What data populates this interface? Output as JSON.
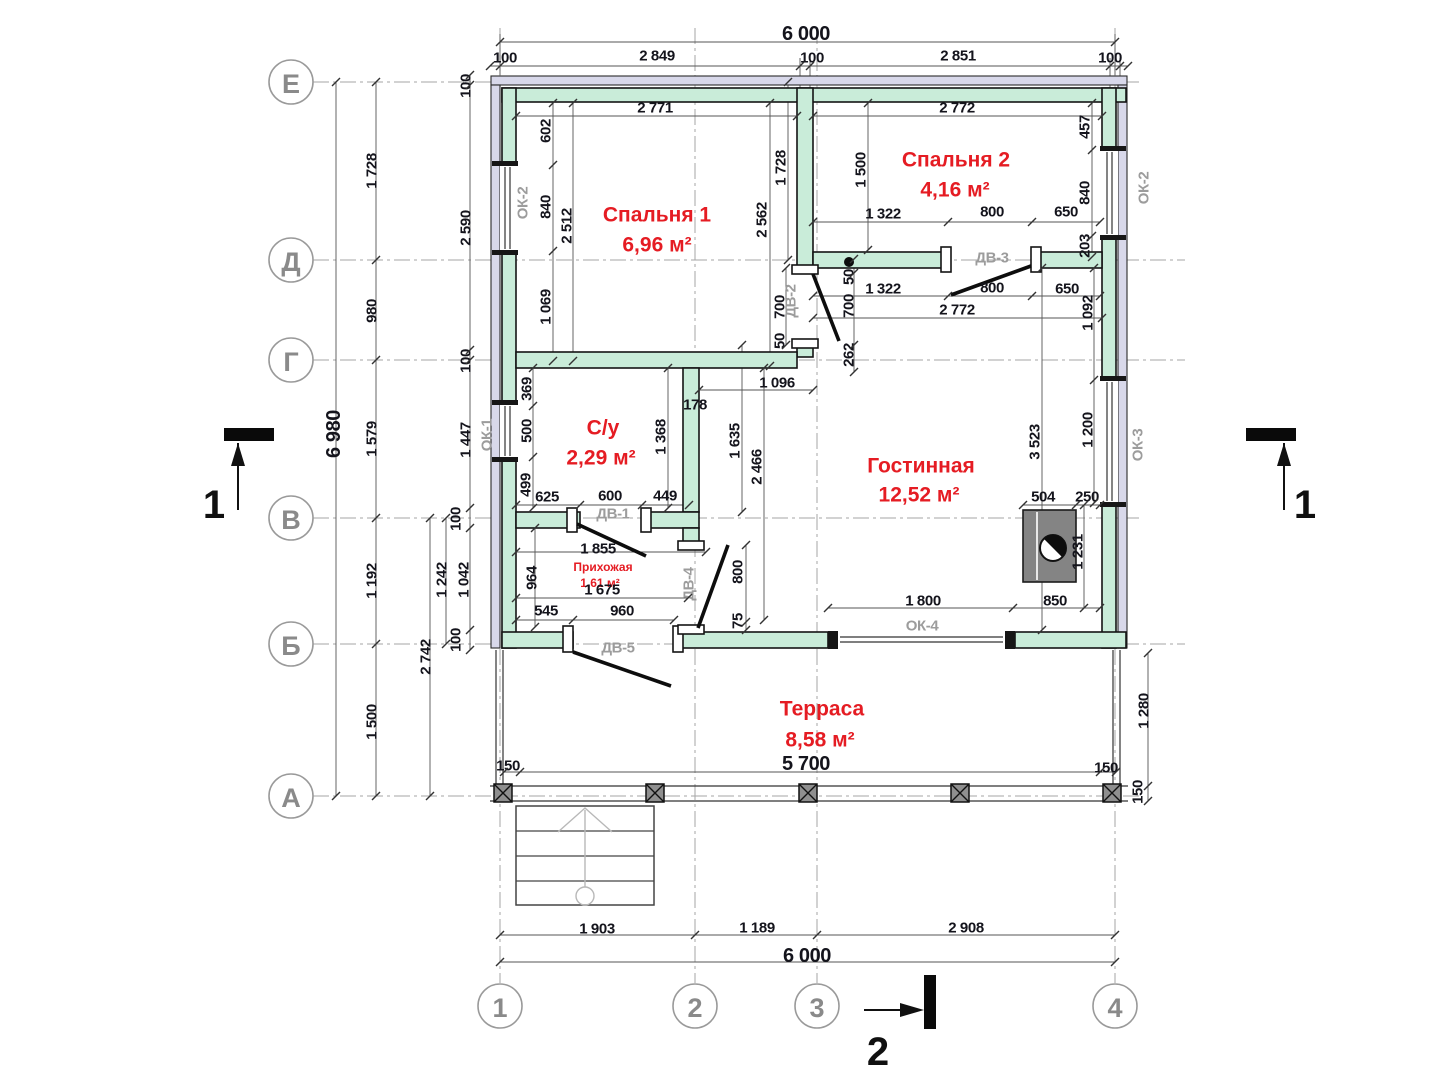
{
  "drawing": {
    "kind": "house floor plan",
    "overall_width": "6 000",
    "overall_height": "6 980"
  },
  "rooms": [
    {
      "name": "Спальня 1",
      "area": "6,96 м²"
    },
    {
      "name": "Спальня 2",
      "area": "4,16 м²"
    },
    {
      "name": "С/у",
      "area": "2,29 м²"
    },
    {
      "name": "Гостинная",
      "area": "12,52 м²"
    },
    {
      "name": "Прихожая",
      "area": "1,61 м²"
    },
    {
      "name": "Терраса",
      "area": "8,58 м²"
    }
  ],
  "axes": {
    "rows": [
      {
        "label": "Е"
      },
      {
        "label": "Д"
      },
      {
        "label": "Г"
      },
      {
        "label": "В"
      },
      {
        "label": "Б"
      },
      {
        "label": "А"
      }
    ],
    "cols": [
      {
        "label": "1"
      },
      {
        "label": "2"
      },
      {
        "label": "3"
      },
      {
        "label": "4"
      }
    ]
  },
  "section_labels": [
    {
      "label": "1"
    },
    {
      "label": "1"
    },
    {
      "label": "2"
    }
  ],
  "opening_labels": [
    {
      "t": "ОК-2",
      "x": 523,
      "y": 203,
      "r": 1
    },
    {
      "t": "ОК-1",
      "x": 487,
      "y": 435,
      "r": 1
    },
    {
      "t": "ОК-2",
      "x": 1144,
      "y": 188,
      "r": 1
    },
    {
      "t": "ОК-3",
      "x": 1138,
      "y": 445,
      "r": 1
    },
    {
      "t": "ОК-4",
      "x": 922,
      "y": 626
    },
    {
      "t": "ДВ-1",
      "x": 613,
      "y": 514
    },
    {
      "t": "ДВ-2",
      "x": 791,
      "y": 301,
      "r": 1
    },
    {
      "t": "ДВ-3",
      "x": 992,
      "y": 258
    },
    {
      "t": "ДВ-4",
      "x": 689,
      "y": 584,
      "r": 1
    },
    {
      "t": "ДВ-5",
      "x": 618,
      "y": 648
    }
  ],
  "dimension_labels": [
    {
      "t": "6 000",
      "x": 806,
      "y": 34,
      "c": "L"
    },
    {
      "t": "100",
      "x": 505,
      "y": 58
    },
    {
      "t": "2 849",
      "x": 657,
      "y": 56
    },
    {
      "t": "100",
      "x": 812,
      "y": 58
    },
    {
      "t": "2 851",
      "x": 958,
      "y": 56
    },
    {
      "t": "100",
      "x": 1110,
      "y": 58
    },
    {
      "t": "2 771",
      "x": 655,
      "y": 108
    },
    {
      "t": "2 772",
      "x": 957,
      "y": 108
    },
    {
      "t": "602",
      "x": 546,
      "y": 131,
      "r": 1
    },
    {
      "t": "840",
      "x": 546,
      "y": 207,
      "r": 1
    },
    {
      "t": "1 069",
      "x": 546,
      "y": 307,
      "r": 1
    },
    {
      "t": "2 512",
      "x": 567,
      "y": 226,
      "r": 1
    },
    {
      "t": "2 562",
      "x": 762,
      "y": 220,
      "r": 1
    },
    {
      "t": "1 728",
      "x": 781,
      "y": 168,
      "r": 1
    },
    {
      "t": "1 500",
      "x": 861,
      "y": 170,
      "r": 1
    },
    {
      "t": "457",
      "x": 1085,
      "y": 127,
      "r": 1
    },
    {
      "t": "840",
      "x": 1085,
      "y": 193,
      "r": 1
    },
    {
      "t": "203",
      "x": 1085,
      "y": 246,
      "r": 1
    },
    {
      "t": "1 322",
      "x": 883,
      "y": 214
    },
    {
      "t": "800",
      "x": 992,
      "y": 212
    },
    {
      "t": "650",
      "x": 1066,
      "y": 212
    },
    {
      "t": "1 322",
      "x": 883,
      "y": 289
    },
    {
      "t": "800",
      "x": 992,
      "y": 288
    },
    {
      "t": "650",
      "x": 1067,
      "y": 289
    },
    {
      "t": "2 772",
      "x": 957,
      "y": 310
    },
    {
      "t": "50",
      "x": 849,
      "y": 277,
      "r": 1
    },
    {
      "t": "700",
      "x": 849,
      "y": 306,
      "r": 1
    },
    {
      "t": "262",
      "x": 849,
      "y": 355,
      "r": 1
    },
    {
      "t": "700",
      "x": 780,
      "y": 307,
      "r": 1
    },
    {
      "t": "50",
      "x": 780,
      "y": 341,
      "r": 1
    },
    {
      "t": "1 092",
      "x": 1088,
      "y": 313,
      "r": 1
    },
    {
      "t": "1 200",
      "x": 1088,
      "y": 430,
      "r": 1
    },
    {
      "t": "3 523",
      "x": 1035,
      "y": 442,
      "r": 1
    },
    {
      "t": "504",
      "x": 1043,
      "y": 497
    },
    {
      "t": "250",
      "x": 1087,
      "y": 497
    },
    {
      "t": "1 231",
      "x": 1078,
      "y": 552,
      "r": 1
    },
    {
      "t": "850",
      "x": 1055,
      "y": 601
    },
    {
      "t": "1 800",
      "x": 923,
      "y": 601
    },
    {
      "t": "369",
      "x": 527,
      "y": 389,
      "r": 1
    },
    {
      "t": "500",
      "x": 527,
      "y": 431,
      "r": 1
    },
    {
      "t": "499",
      "x": 526,
      "y": 485,
      "r": 1
    },
    {
      "t": "1 368",
      "x": 661,
      "y": 437,
      "r": 1
    },
    {
      "t": "178",
      "x": 695,
      "y": 405
    },
    {
      "t": "1 096",
      "x": 777,
      "y": 383
    },
    {
      "t": "1 635",
      "x": 735,
      "y": 441,
      "r": 1
    },
    {
      "t": "2 466",
      "x": 757,
      "y": 467,
      "r": 1
    },
    {
      "t": "625",
      "x": 547,
      "y": 497
    },
    {
      "t": "600",
      "x": 610,
      "y": 496
    },
    {
      "t": "449",
      "x": 665,
      "y": 496
    },
    {
      "t": "1 855",
      "x": 598,
      "y": 549
    },
    {
      "t": "1 675",
      "x": 602,
      "y": 590
    },
    {
      "t": "964",
      "x": 532,
      "y": 578,
      "r": 1
    },
    {
      "t": "545",
      "x": 546,
      "y": 611
    },
    {
      "t": "960",
      "x": 622,
      "y": 611
    },
    {
      "t": "800",
      "x": 738,
      "y": 572,
      "r": 1
    },
    {
      "t": "75",
      "x": 738,
      "y": 621,
      "r": 1
    },
    {
      "t": "6 980",
      "x": 334,
      "y": 434,
      "c": "L",
      "r": 1
    },
    {
      "t": "1 728",
      "x": 372,
      "y": 171,
      "r": 1
    },
    {
      "t": "980",
      "x": 372,
      "y": 311,
      "r": 1
    },
    {
      "t": "1 579",
      "x": 372,
      "y": 439,
      "r": 1
    },
    {
      "t": "1 192",
      "x": 372,
      "y": 581,
      "r": 1
    },
    {
      "t": "1 500",
      "x": 372,
      "y": 722,
      "r": 1
    },
    {
      "t": "2 742",
      "x": 426,
      "y": 657,
      "r": 1
    },
    {
      "t": "1 242",
      "x": 442,
      "y": 580,
      "r": 1
    },
    {
      "t": "1 042",
      "x": 464,
      "y": 580,
      "r": 1
    },
    {
      "t": "100",
      "x": 456,
      "y": 519,
      "r": 1
    },
    {
      "t": "100",
      "x": 456,
      "y": 640,
      "r": 1
    },
    {
      "t": "100",
      "x": 466,
      "y": 86,
      "r": 1
    },
    {
      "t": "2 590",
      "x": 466,
      "y": 228,
      "r": 1
    },
    {
      "t": "100",
      "x": 466,
      "y": 361,
      "r": 1
    },
    {
      "t": "1 447",
      "x": 466,
      "y": 440,
      "r": 1
    },
    {
      "t": "1 280",
      "x": 1144,
      "y": 711,
      "r": 1
    },
    {
      "t": "150",
      "x": 1106,
      "y": 768
    },
    {
      "t": "150",
      "x": 1138,
      "y": 792,
      "r": 1
    },
    {
      "t": "150",
      "x": 508,
      "y": 766
    },
    {
      "t": "5 700",
      "x": 806,
      "y": 764,
      "c": "L"
    },
    {
      "t": "1 903",
      "x": 597,
      "y": 929
    },
    {
      "t": "1 189",
      "x": 757,
      "y": 928
    },
    {
      "t": "2 908",
      "x": 966,
      "y": 928
    },
    {
      "t": "6 000",
      "x": 807,
      "y": 956,
      "c": "L"
    }
  ],
  "colors": {
    "wall_fill": "#c9ecd9",
    "wall_outer_band": "#d8d8ea",
    "room_text": "#e51c23",
    "dim_text": "#14141c",
    "tag_text": "#9c9c9c",
    "axis_text": "#8a8a8a"
  }
}
